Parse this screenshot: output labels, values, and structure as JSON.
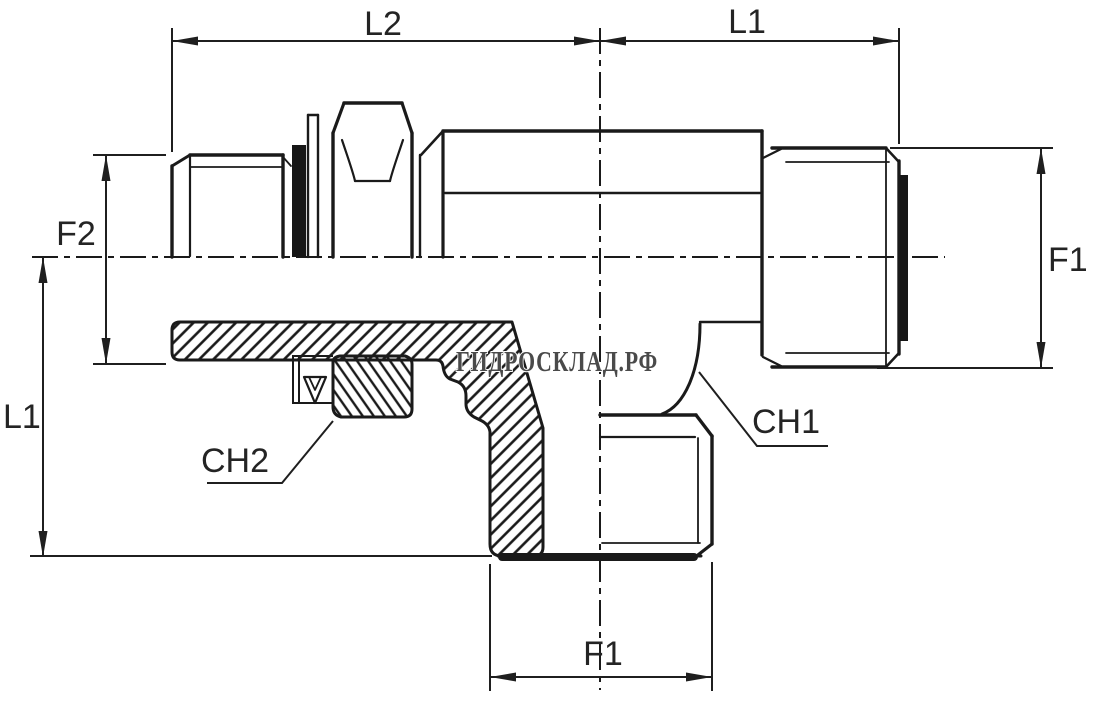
{
  "drawing": {
    "type": "technical-drawing",
    "subject": "hydraulic adjustable male stud tee fitting, half-section view",
    "colors": {
      "background": "#ffffff",
      "line": "#1a1a1a",
      "dim_text": "#242424",
      "watermark_fill": "#4a4a4a",
      "watermark_outline": "#ffffff"
    },
    "dimensions": {
      "l2": {
        "label": "L2"
      },
      "l1_top": {
        "label": "L1"
      },
      "f2": {
        "label": "F2"
      },
      "l1_left": {
        "label": "L1"
      },
      "f1_right": {
        "label": "F1"
      },
      "f1_bottom": {
        "label": "F1"
      }
    },
    "callouts": {
      "ch1": {
        "label": "CH1"
      },
      "ch2": {
        "label": "CH2"
      }
    },
    "watermark": {
      "text": "ГИДРОСКЛАД.РФ"
    }
  }
}
